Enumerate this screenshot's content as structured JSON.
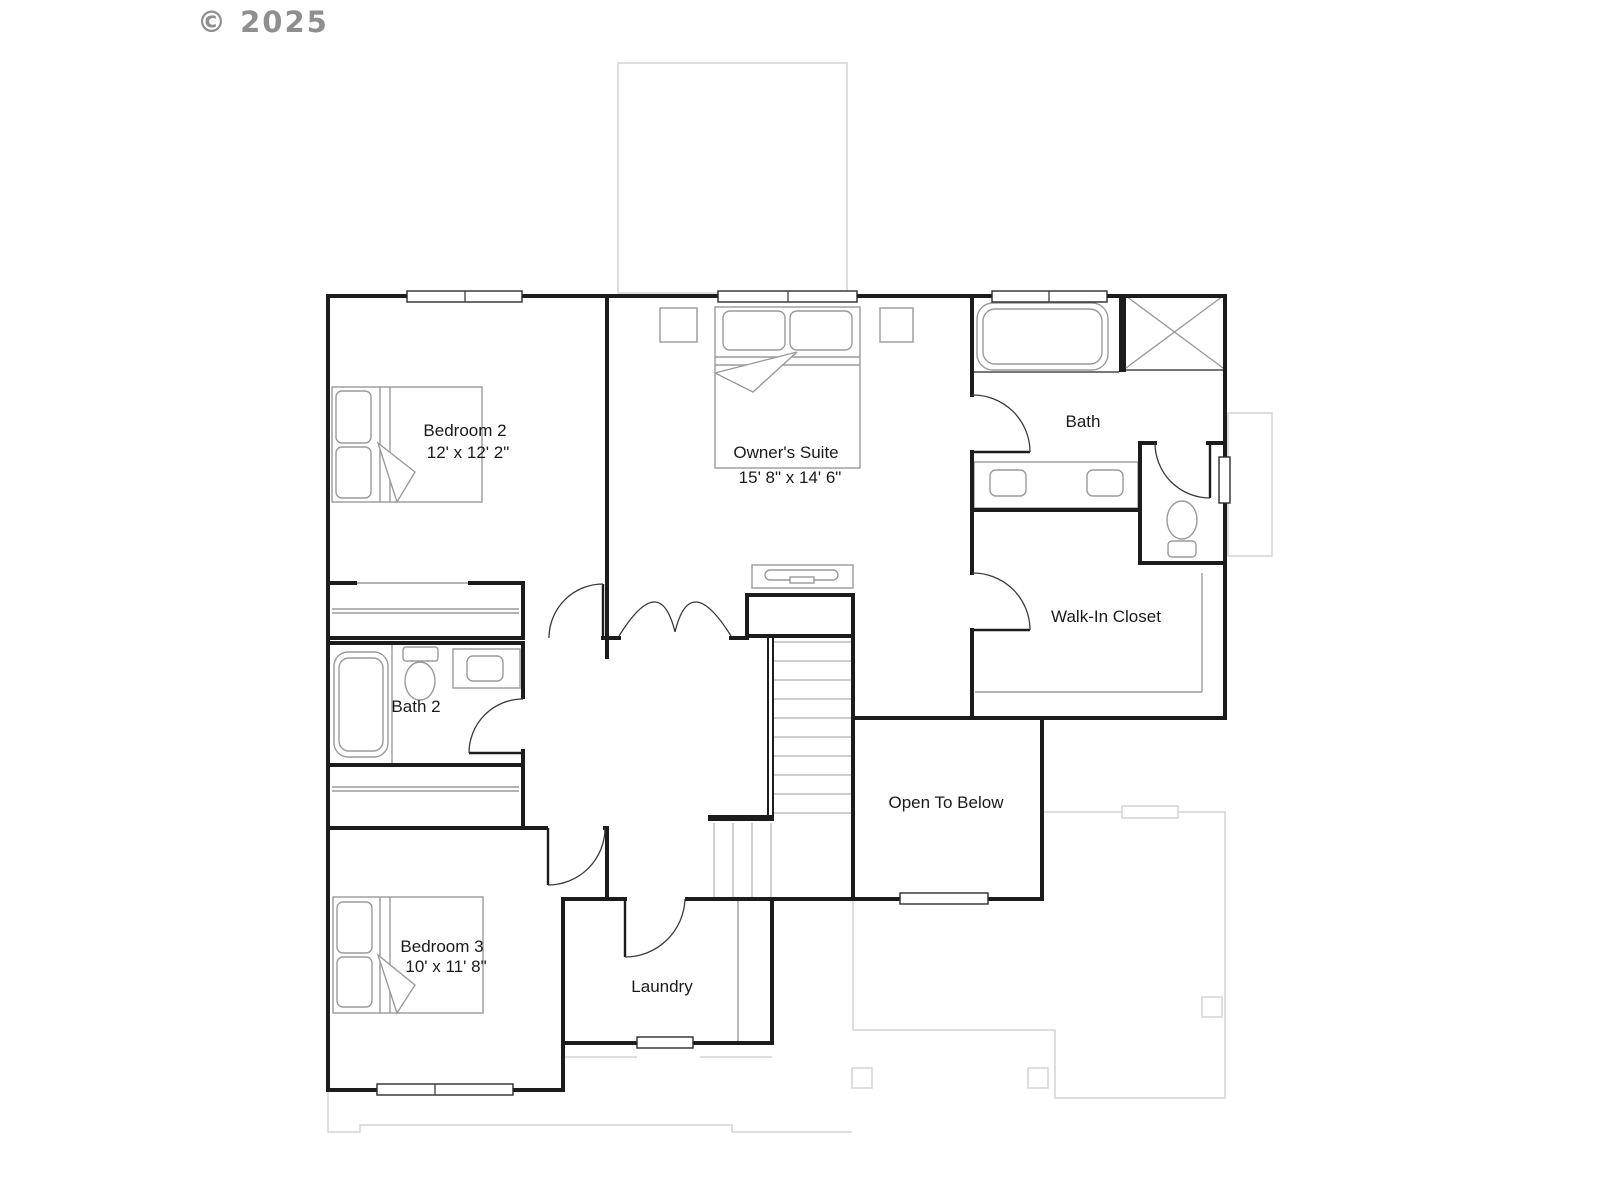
{
  "watermark": "© 2025",
  "rooms": {
    "bedroom2": {
      "name": "Bedroom 2",
      "dims": "12' x 12' 2\""
    },
    "owners_suite": {
      "name": "Owner's Suite",
      "dims": "15' 8\" x 14' 6\""
    },
    "bath": {
      "name": "Bath"
    },
    "walk_in_closet": {
      "name": "Walk-In Closet"
    },
    "bath2": {
      "name": "Bath 2"
    },
    "open_to_below": {
      "name": "Open To Below"
    },
    "bedroom3": {
      "name": "Bedroom 3",
      "dims": "10' x 11' 8\""
    },
    "laundry": {
      "name": "Laundry"
    }
  },
  "colors": {
    "wall": "#1c1c1c",
    "fixture": "#9a9a9a",
    "ghost": "#d4d4d4",
    "label": "#1a1a1a",
    "watermark": "#8f8f8f"
  },
  "icons": {
    "bed-icon": "double bed with pillows and folded sheet",
    "bathtub-icon": "rounded bathtub outline",
    "shower-icon": "square with X diagonals",
    "toilet-icon": "toilet bowl with tank",
    "sink-icon": "rounded basin in vanity counter",
    "dresser-icon": "dresser with handle",
    "nightstand-icon": "small square table",
    "stairs-icon": "parallel tread lines",
    "door-icon": "door leaf with quarter-circle swing arc",
    "window-icon": "hollow bar in wall"
  }
}
